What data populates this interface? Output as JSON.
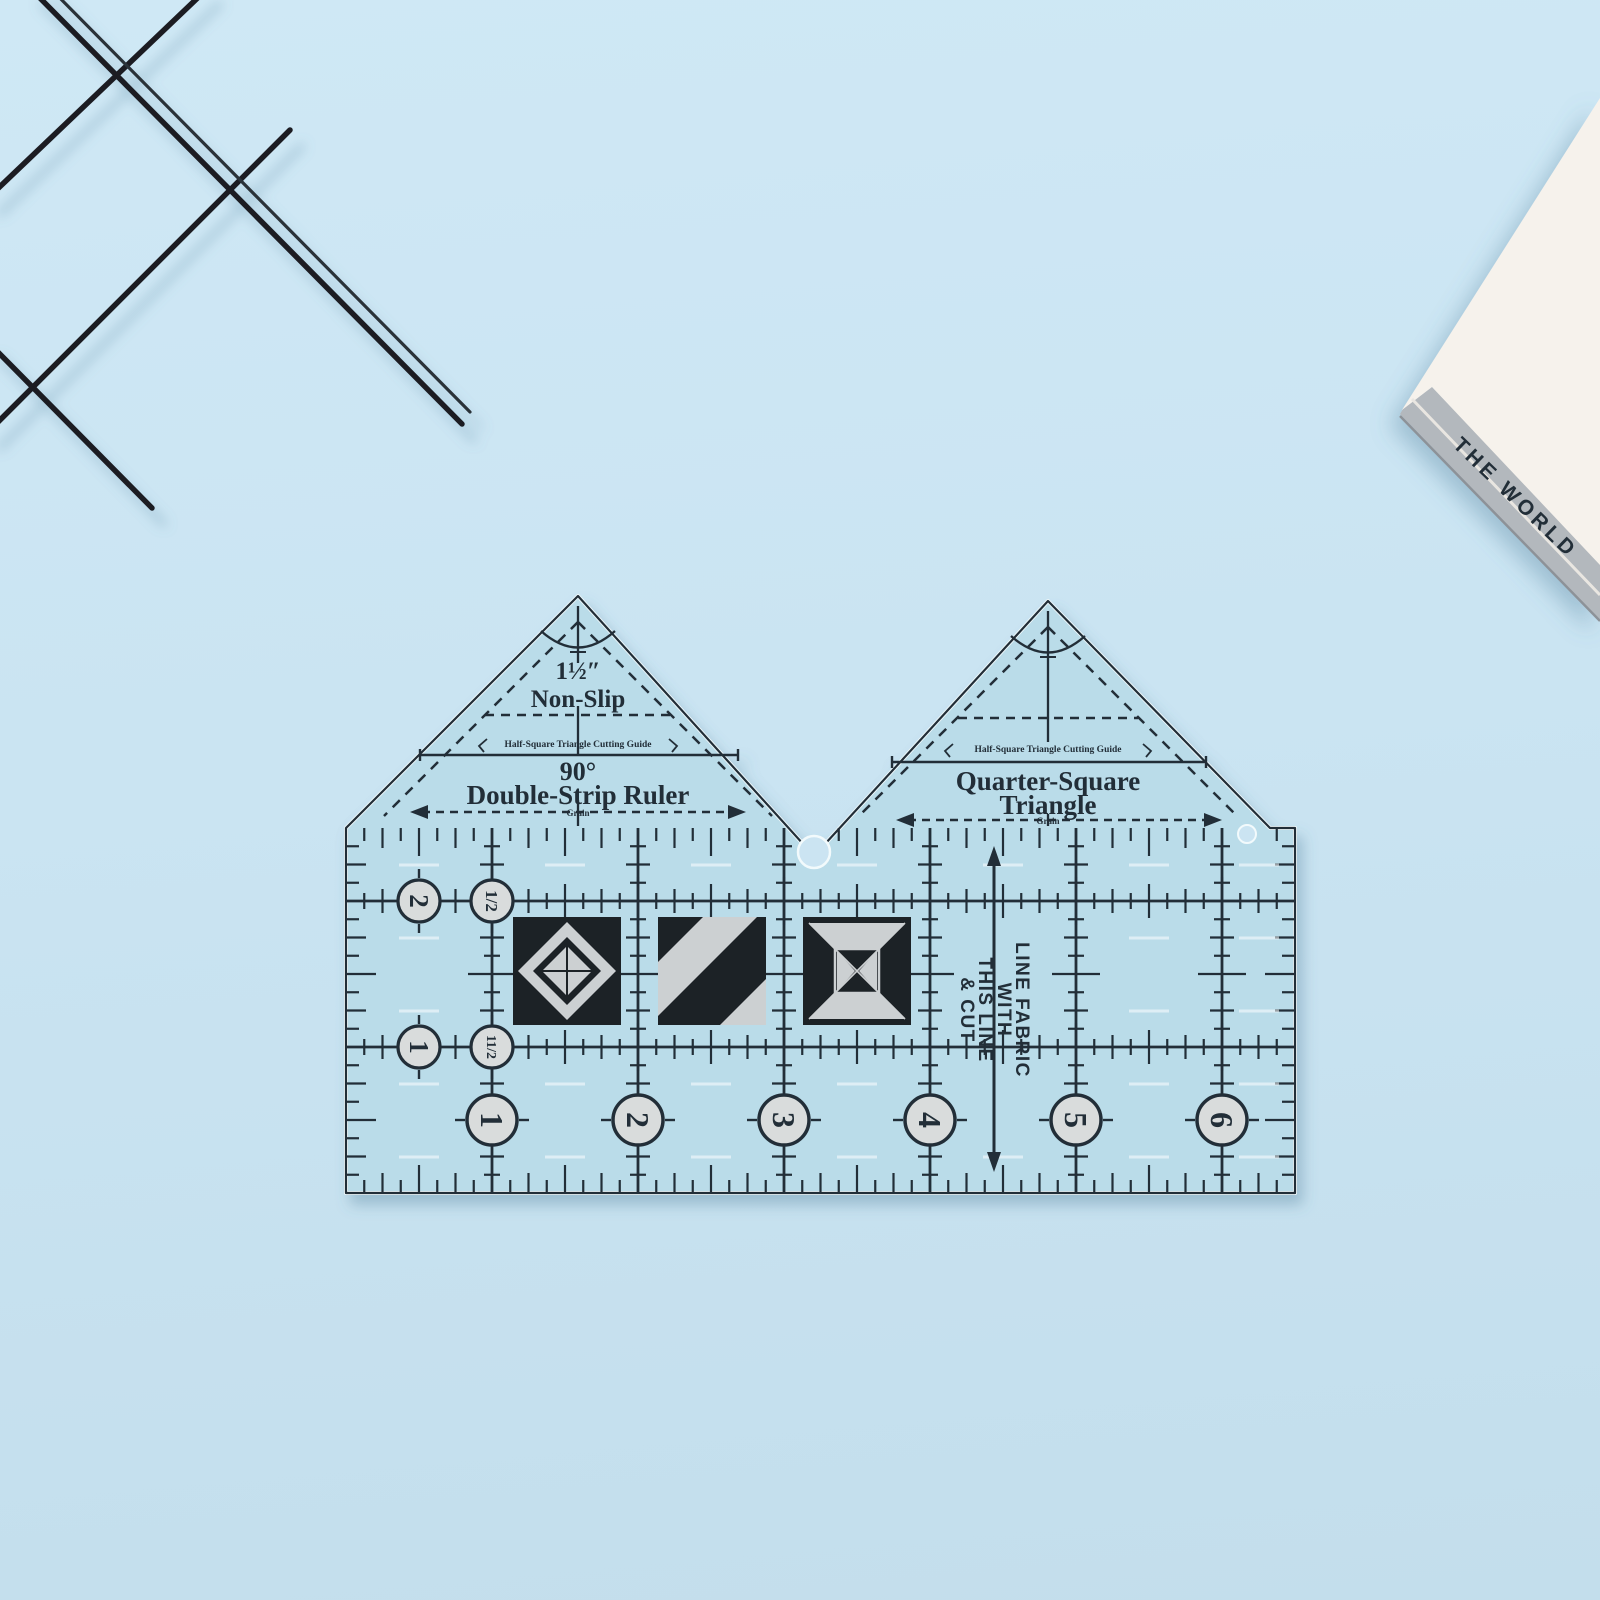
{
  "book": {
    "spine_text": "THE WORLD"
  },
  "ruler": {
    "left_triangle": {
      "size": "1½″",
      "nonslip": "Non-Slip",
      "cutting_guide": "Half-Square Triangle Cutting Guide",
      "angle": "90°",
      "name": "Double-Strip Ruler",
      "grain": "Grain"
    },
    "right_triangle": {
      "cutting_guide": "Half-Square Triangle Cutting Guide",
      "name_line1": "Quarter-Square",
      "name_line2": "Triangle",
      "grain": "Grain"
    },
    "fabric_note": [
      "LINE FABRIC",
      "WITH",
      "THIS LINE",
      "& CUT"
    ],
    "left_scale": [
      "2",
      "1"
    ],
    "half_scale": [
      "1/2",
      "11/2"
    ],
    "bottom_numbers": [
      "1",
      "2",
      "3",
      "4",
      "5",
      "6"
    ],
    "colors": {
      "background": "#cbe4f2",
      "ruler_fill": "#badce9",
      "ink": "#232f38",
      "circle_fill": "#d9dcdc",
      "pattern_black": "#1d2125",
      "pattern_gray": "#ccd0d2",
      "wire": "#1b1d22",
      "book_cover": "#f6f2ec",
      "book_spine": "#b3b8bd"
    }
  }
}
